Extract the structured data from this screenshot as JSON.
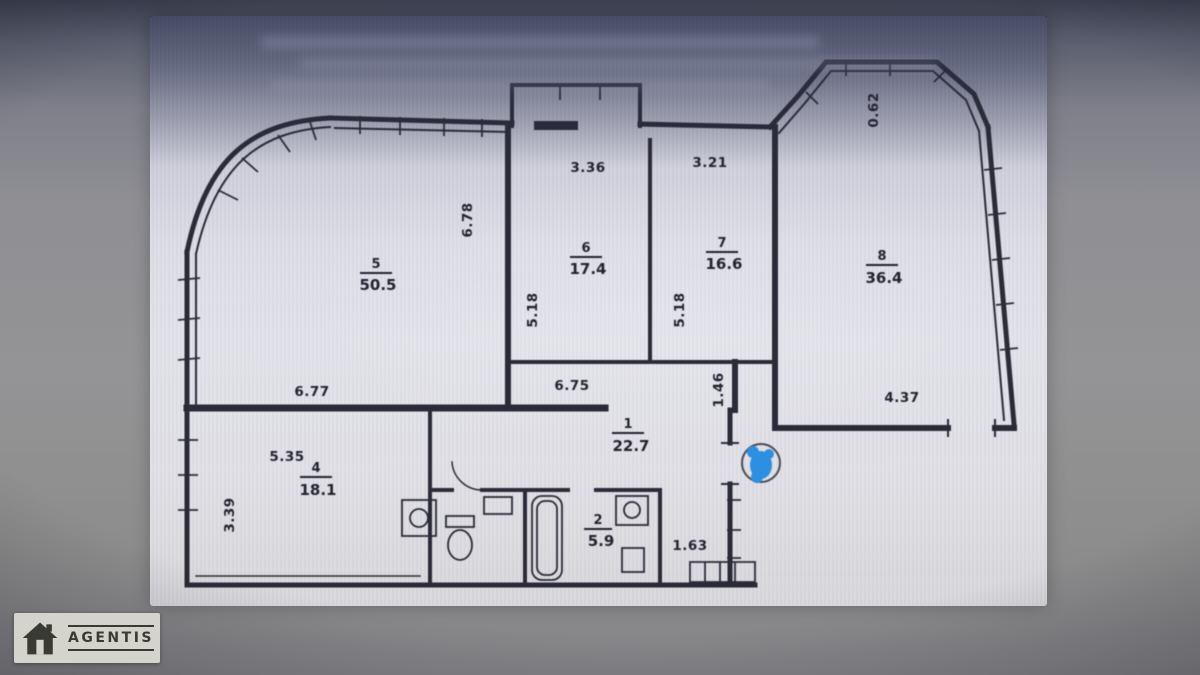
{
  "watermark": {
    "brand": "AGENTIS"
  },
  "colors": {
    "paper": "#dedee6",
    "ink": "#2b2b38",
    "marker_blue": "#2d8fe2",
    "logo_bg": "#d5d4cc",
    "logo_ink": "#3a3a35"
  },
  "floor_plan": {
    "rooms": [
      {
        "id": "5",
        "area": "50.5"
      },
      {
        "id": "6",
        "area": "17.4"
      },
      {
        "id": "7",
        "area": "16.6"
      },
      {
        "id": "8",
        "area": "36.4"
      },
      {
        "id": "1",
        "area": "22.7"
      },
      {
        "id": "4",
        "area": "18.1"
      },
      {
        "id": "2",
        "area": "5.9"
      }
    ],
    "dimensions": {
      "room5_top": "6.78",
      "room6_top": "3.36",
      "room7_top": "3.21",
      "bay_side": "0.62",
      "room6_side": "5.18",
      "room7_side": "5.18",
      "room5_bottom": "6.77",
      "hall_top": "6.75",
      "hall_side": "1.46",
      "room8_bottom": "4.37",
      "room4_top": "5.35",
      "room4_side": "3.39",
      "corridor": "1.63"
    }
  }
}
